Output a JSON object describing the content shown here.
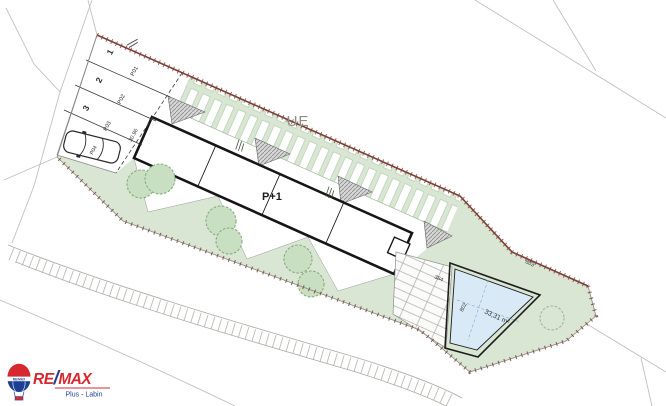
{
  "plan": {
    "building_label": "P+1",
    "street_label": "UE",
    "dims": {
      "parking_edge": "30.96",
      "boundary_edge": "803",
      "pool_side": "802",
      "deck": "384"
    },
    "pool": {
      "area_label": "33,31 m²"
    },
    "parking": {
      "space_numbers": [
        "1",
        "2",
        "3"
      ],
      "space_codes": [
        "P01",
        "P02",
        "P03",
        "P04"
      ]
    }
  },
  "logo": {
    "brand_re": "RE",
    "brand_slash": "/",
    "brand_max": "MAX",
    "balloon_text": "RE/MAX",
    "subtitle": "Plus - Labin"
  },
  "colors": {
    "landscape_green": "#d8e6d3",
    "tree_green": "#86ae7c",
    "pool_blue": "#d9e9f5",
    "boundary_brown": "#7c4036",
    "remax_red": "#d7282f",
    "remax_blue": "#1c3f94",
    "context_gray": "#c3c0bc"
  }
}
